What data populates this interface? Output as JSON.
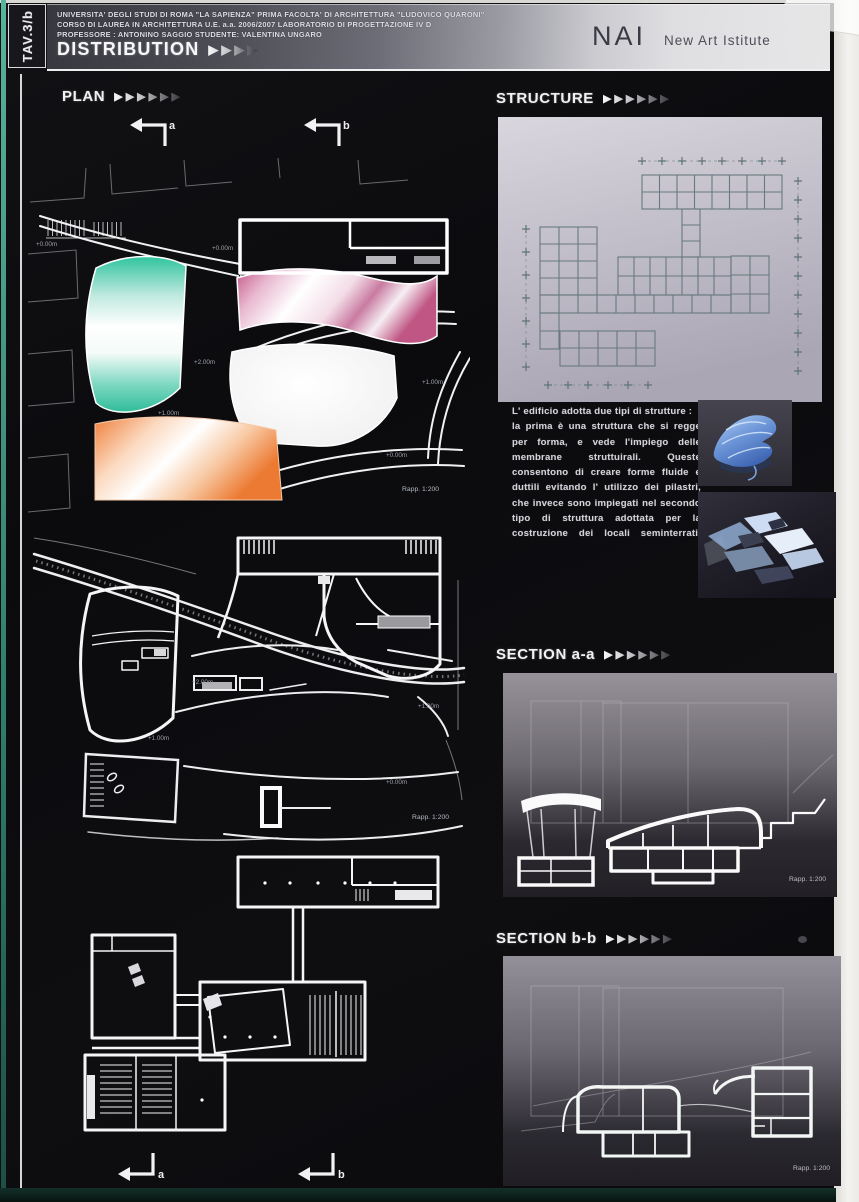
{
  "board": {
    "tav_label": "TAV.3/b",
    "header": {
      "line1": "UNIVERSITA' DEGLI STUDI DI ROMA \"LA SAPIENZA\" PRIMA FACOLTA' DI ARCHITETTURA \"LUDOVICO QUARONI\"",
      "line2": "CORSO DI LAUREA IN ARCHITETTURA U.E.    a.a. 2006/2007   LABORATORIO DI PROGETTAZIONE IV D",
      "line3": "PROFESSORE : ANTONINO SAGGIO   STUDENTE: VALENTINA UNGARO",
      "title": "DISTRIBUTION",
      "title_arrows": "▶▶▶▶",
      "logo_text": "NAI",
      "logo_subtitle": "New Art Istitute"
    },
    "plan": {
      "title": "PLAN",
      "arrows": "▶▶▶▶▶▶"
    },
    "structure": {
      "title": "STRUCTURE",
      "arrows": "▶▶▶▶▶▶",
      "para1": "L' edificio adotta due tipi di strutture :",
      "para2": "la prima è una struttura che si regge per forma, e vede l'impiego delle membrane struttuirali. Queste consentono di creare forme fluide e duttili evitando l' utilizzo dei pilastri, che invece sono impiegati nel secondo tipo di struttura adottata per la costruzione dei locali seminterrati."
    },
    "section_aa": {
      "title": "SECTION a-a",
      "arrows": "▶▶▶▶▶▶"
    },
    "section_bb": {
      "title": "SECTION b-b",
      "arrows": "▶▶▶▶▶▶"
    },
    "markers": {
      "a": "a",
      "b": "b"
    },
    "annotations": {
      "scale": "Rapp. 1:200",
      "elev_0": "+0.00m",
      "elev_1": "+1.00m",
      "elev_2": "+2.00m"
    },
    "colors": {
      "teal_zone": "#2fc49e",
      "pink_zone": "#c45a8c",
      "orange_zone": "#ef7f3a",
      "structure_panel": "#c9c5d1",
      "membrane_blue": "#7fa9e3"
    }
  }
}
